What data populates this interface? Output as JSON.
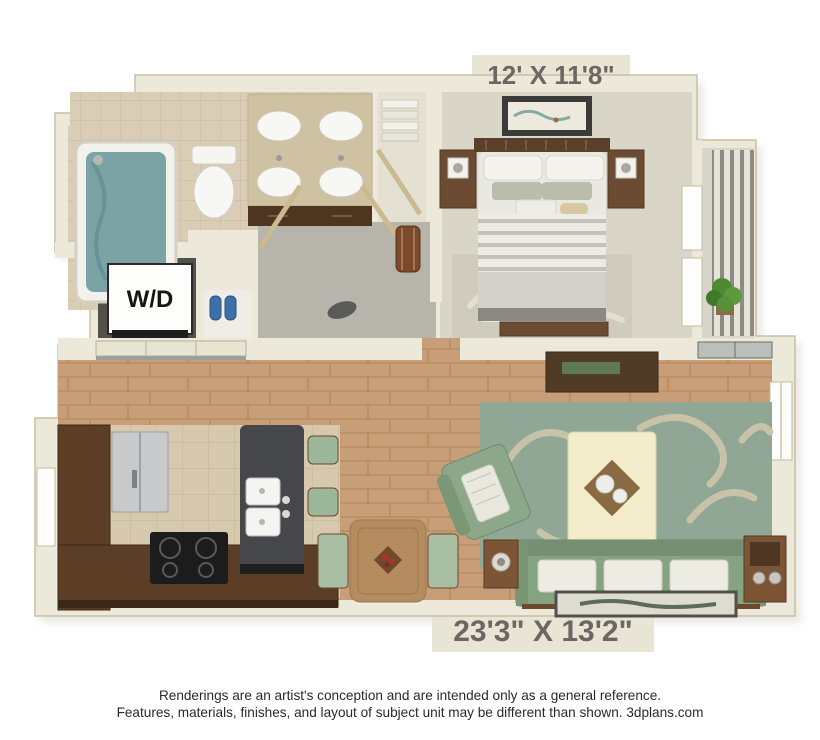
{
  "labels": {
    "bedroom_dimensions": "12' X 11'8\"",
    "living_area_dimensions": "23'3\" X 13'2\"",
    "washer_dryer": "W/D"
  },
  "footer": {
    "line1": "Renderings are an artist's conception and are intended only as a general reference.",
    "line2": "Features, materials, finishes, and layout of subject unit may be different than shown. 3dplans.com"
  },
  "palette": {
    "wall_cream": "#EDE9DA",
    "wall_edge": "#C6C0A4",
    "wood_floor": "#C79E78",
    "kitchen_tile": "#D7C9AE",
    "bath_tile": "#D9CDB6",
    "bedroom_carpet": "#D9D5C7",
    "hall_carpet": "#B7B4AB",
    "rug_sage": "#8FA794",
    "rug_swirl": "#CEC5AB",
    "sofa_green": "#85A281",
    "ottoman_cream": "#F2ECCB",
    "cabinet_brown": "#5C3D26",
    "island_gray": "#46474A",
    "tub_water": "#7BA3A6",
    "dimension_text": "#6B6762"
  }
}
